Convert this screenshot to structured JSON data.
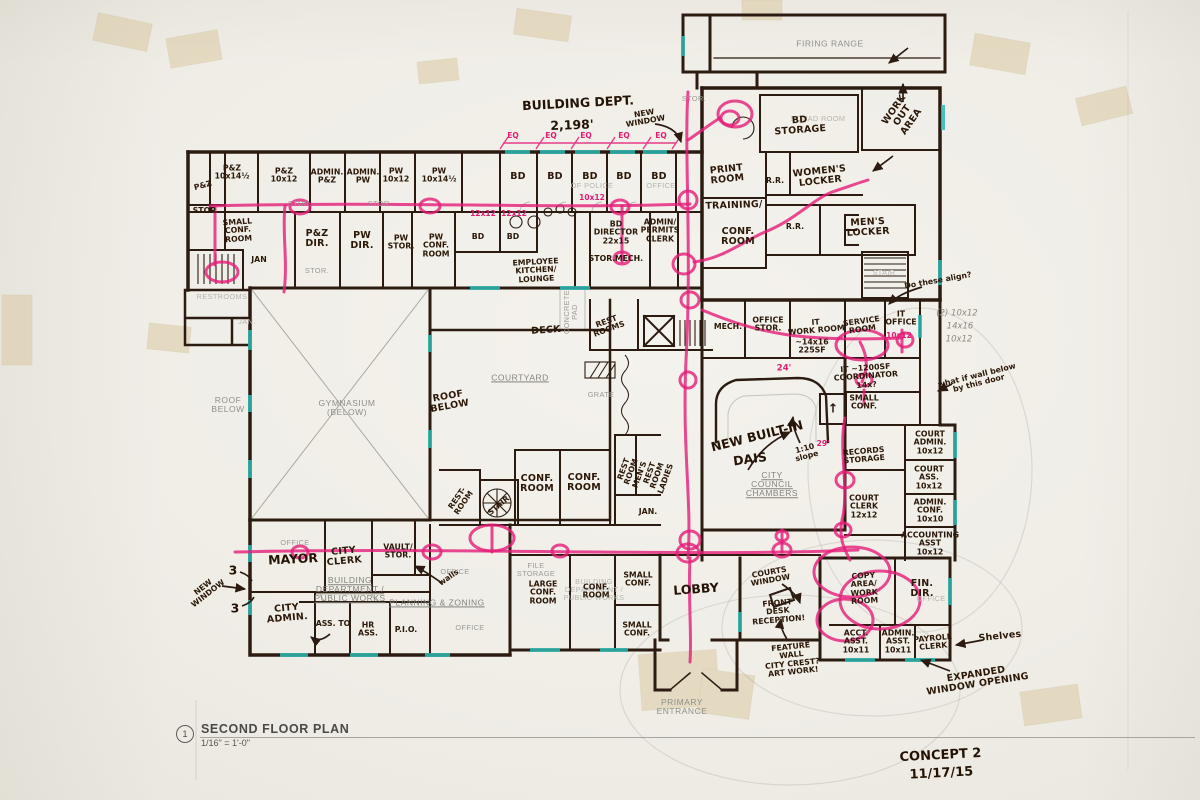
{
  "colors": {
    "ink": "#2b1b10",
    "printed": "#8f8f88",
    "pink": "#e51d78",
    "teal": "#2fb8b2",
    "paper": "#f1efe9",
    "tape": "#d8c79c",
    "pencil": "#8e8a82"
  },
  "title_block": {
    "detail_number": "1",
    "title": "SECOND FLOOR PLAN",
    "scale": "1/16\" = 1'-0\""
  },
  "revision": {
    "concept": "CONCEPT 2",
    "date": "11/17/15"
  },
  "labels": [
    {
      "t": "FIRING RANGE",
      "x": 830,
      "y": 44,
      "c": "pr",
      "n": "room-firing-range"
    },
    {
      "t": "SQUAD ROOM",
      "x": 818,
      "y": 119,
      "c": "prF"
    },
    {
      "t": "BD\nSTORAGE",
      "x": 800,
      "y": 126,
      "c": "hw",
      "r": -4,
      "n": "room-bd-storage"
    },
    {
      "t": "WORK\nOUT\nAREA",
      "x": 903,
      "y": 116,
      "c": "hw",
      "r": -55,
      "n": "room-work-out-area"
    },
    {
      "t": "STOR.",
      "x": 694,
      "y": 99,
      "c": "prS"
    },
    {
      "t": "BUILDING DEPT.",
      "x": 578,
      "y": 103,
      "c": "hwL",
      "r": -3,
      "n": "note-building-dept"
    },
    {
      "t": "2,198'",
      "x": 572,
      "y": 125,
      "c": "hwL",
      "r": -2
    },
    {
      "t": "NEW\nWINDOW",
      "x": 645,
      "y": 118,
      "c": "hwS",
      "r": -10,
      "n": "note-new-window-top"
    },
    {
      "t": "EQ",
      "x": 513,
      "y": 136,
      "c": "pkS"
    },
    {
      "t": "EQ",
      "x": 551,
      "y": 136,
      "c": "pkS"
    },
    {
      "t": "EQ",
      "x": 586,
      "y": 136,
      "c": "pkS"
    },
    {
      "t": "EQ",
      "x": 624,
      "y": 136,
      "c": "pkS"
    },
    {
      "t": "EQ",
      "x": 661,
      "y": 136,
      "c": "pkS"
    },
    {
      "t": "P&Z\n10x14½",
      "x": 232,
      "y": 173,
      "c": "hwS"
    },
    {
      "t": "P&Z\n10x12",
      "x": 284,
      "y": 176,
      "c": "hwS"
    },
    {
      "t": "ADMIN.\nP&Z",
      "x": 327,
      "y": 177,
      "c": "hwS"
    },
    {
      "t": "ADMIN.\nPW",
      "x": 363,
      "y": 177,
      "c": "hwS"
    },
    {
      "t": "PW\n10x12",
      "x": 396,
      "y": 176,
      "c": "hwS"
    },
    {
      "t": "PW\n10x14½",
      "x": 439,
      "y": 176,
      "c": "hwS"
    },
    {
      "t": "BD",
      "x": 518,
      "y": 177,
      "c": "hw"
    },
    {
      "t": "BD",
      "x": 555,
      "y": 177,
      "c": "hw"
    },
    {
      "t": "BD",
      "x": 590,
      "y": 177,
      "c": "hw"
    },
    {
      "t": "BD",
      "x": 624,
      "y": 177,
      "c": "hw"
    },
    {
      "t": "BD",
      "x": 659,
      "y": 177,
      "c": "hw"
    },
    {
      "t": "OF POLICE",
      "x": 592,
      "y": 186,
      "c": "prF"
    },
    {
      "t": "OFFICE",
      "x": 661,
      "y": 186,
      "c": "prF"
    },
    {
      "t": "10x12",
      "x": 592,
      "y": 198,
      "c": "pkS"
    },
    {
      "t": "P&Z",
      "x": 203,
      "y": 186,
      "c": "hwS",
      "r": -15
    },
    {
      "t": "STOR.",
      "x": 206,
      "y": 211,
      "c": "hwS"
    },
    {
      "t": "SMALL\nCONF.\nROOM",
      "x": 238,
      "y": 231,
      "c": "hwS",
      "r": -4
    },
    {
      "t": "STOR.",
      "x": 300,
      "y": 204,
      "c": "prS"
    },
    {
      "t": "STOR.",
      "x": 380,
      "y": 204,
      "c": "prS"
    },
    {
      "t": "P&Z\nDIR.",
      "x": 317,
      "y": 239,
      "c": "hw"
    },
    {
      "t": "PW\nDIR.",
      "x": 362,
      "y": 241,
      "c": "hw"
    },
    {
      "t": "PW\nSTOR.",
      "x": 401,
      "y": 243,
      "c": "hwS"
    },
    {
      "t": "PW\nCONF.\nROOM",
      "x": 436,
      "y": 246,
      "c": "hwS"
    },
    {
      "t": "STOR.",
      "x": 317,
      "y": 271,
      "c": "prS"
    },
    {
      "t": "JAN",
      "x": 259,
      "y": 260,
      "c": "hwS"
    },
    {
      "t": "12x12",
      "x": 483,
      "y": 214,
      "c": "pkS"
    },
    {
      "t": "12x12",
      "x": 514,
      "y": 214,
      "c": "pkS"
    },
    {
      "t": "BD",
      "x": 478,
      "y": 237,
      "c": "hwS"
    },
    {
      "t": "BD",
      "x": 513,
      "y": 237,
      "c": "hwS"
    },
    {
      "t": "EMPLOYEE\nKITCHEN/\nLOUNGE",
      "x": 536,
      "y": 271,
      "c": "hwS",
      "r": -3,
      "n": "room-employee-kitchen"
    },
    {
      "t": "BD\nDIRECTOR\n22x15",
      "x": 616,
      "y": 233,
      "c": "hwS",
      "n": "room-bd-director"
    },
    {
      "t": "STOR.",
      "x": 602,
      "y": 259,
      "c": "hwS"
    },
    {
      "t": "MECH.",
      "x": 629,
      "y": 259,
      "c": "hwS"
    },
    {
      "t": "ADMIN/\nPERMITS\nCLERK",
      "x": 660,
      "y": 231,
      "c": "hwS"
    },
    {
      "t": "PRINT\nROOM",
      "x": 727,
      "y": 175,
      "c": "hw",
      "r": -6
    },
    {
      "t": "R.R.",
      "x": 775,
      "y": 181,
      "c": "hwS"
    },
    {
      "t": "WOMEN'S\nLOCKER",
      "x": 820,
      "y": 177,
      "c": "hw",
      "r": -6,
      "n": "room-womens-locker"
    },
    {
      "t": "TRAINING/",
      "x": 734,
      "y": 206,
      "c": "hw",
      "r": -2
    },
    {
      "t": "CONF.\nROOM",
      "x": 738,
      "y": 237,
      "c": "hw"
    },
    {
      "t": "R.R.",
      "x": 795,
      "y": 227,
      "c": "hwS"
    },
    {
      "t": "MEN'S\nLOCKER",
      "x": 868,
      "y": 228,
      "c": "hw",
      "r": -3,
      "n": "room-mens-locker"
    },
    {
      "t": "STAIR",
      "x": 884,
      "y": 273,
      "c": "prF"
    },
    {
      "t": "Do these align?",
      "x": 938,
      "y": 281,
      "c": "hwS",
      "r": -10,
      "n": "note-do-these-align"
    },
    {
      "t": "(2) 10x12",
      "x": 957,
      "y": 314,
      "c": "pc"
    },
    {
      "t": "14x16",
      "x": 960,
      "y": 327,
      "c": "pc"
    },
    {
      "t": "10x12",
      "x": 959,
      "y": 340,
      "c": "pc"
    },
    {
      "t": "what if wall below\nby this door",
      "x": 978,
      "y": 380,
      "c": "hwS",
      "r": -14,
      "n": "note-wall-below"
    },
    {
      "t": "MECH.",
      "x": 728,
      "y": 327,
      "c": "hwS"
    },
    {
      "t": "OFFICE\nSTOR.",
      "x": 768,
      "y": 325,
      "c": "hwS"
    },
    {
      "t": "IT\nWORK ROOM",
      "x": 816,
      "y": 327,
      "c": "hwS",
      "r": -5
    },
    {
      "t": "~14x16\n225SF",
      "x": 812,
      "y": 347,
      "c": "hwS"
    },
    {
      "t": "SERVICE\nROOM",
      "x": 862,
      "y": 326,
      "c": "hwS",
      "r": -8
    },
    {
      "t": "IT\nOFFICE",
      "x": 901,
      "y": 319,
      "c": "hwS"
    },
    {
      "t": "10x12",
      "x": 899,
      "y": 336,
      "c": "pkS"
    },
    {
      "t": "IT ~1200SF\nCOORDINATOR\n14x?",
      "x": 866,
      "y": 377,
      "c": "hwS",
      "r": -4
    },
    {
      "t": "SMALL\nCONF.",
      "x": 864,
      "y": 403,
      "c": "hwS"
    },
    {
      "t": "24'",
      "x": 784,
      "y": 369,
      "c": "pk"
    },
    {
      "t": "29'",
      "x": 823,
      "y": 444,
      "c": "pkS"
    },
    {
      "t": "1:10\nslope",
      "x": 806,
      "y": 453,
      "c": "hwS",
      "r": -15
    },
    {
      "t": "NEW BUILT-IN",
      "x": 757,
      "y": 436,
      "c": "hwL",
      "r": -14,
      "n": "note-new-built-in-dais"
    },
    {
      "t": "DAIS",
      "x": 750,
      "y": 459,
      "c": "hwL",
      "r": -8
    },
    {
      "t": "CITY\nCOUNCIL\nCHAMBERS",
      "x": 772,
      "y": 485,
      "c": "prU",
      "n": "room-council-chambers"
    },
    {
      "t": "REST\nROOMS",
      "x": 608,
      "y": 326,
      "c": "hwS",
      "r": -20
    },
    {
      "t": "DECK",
      "x": 546,
      "y": 331,
      "c": "hw",
      "r": -4
    },
    {
      "t": "CONCRETE\nPAD",
      "x": 571,
      "y": 312,
      "c": "prS",
      "r": -90
    },
    {
      "t": "COURTYARD",
      "x": 520,
      "y": 378,
      "c": "prU",
      "n": "room-courtyard"
    },
    {
      "t": "GRATE",
      "x": 601,
      "y": 395,
      "c": "prS"
    },
    {
      "t": "ROOF\nBELOW",
      "x": 228,
      "y": 405,
      "c": "pr"
    },
    {
      "t": "GYMNASIUM\n(BELOW)",
      "x": 347,
      "y": 408,
      "c": "pr",
      "n": "room-gymnasium"
    },
    {
      "t": "ROOF\nBELOW",
      "x": 449,
      "y": 402,
      "c": "hw",
      "r": -10
    },
    {
      "t": "RESTROOMS",
      "x": 222,
      "y": 297,
      "c": "prF"
    },
    {
      "t": "JAN.",
      "x": 247,
      "y": 322,
      "c": "prF"
    },
    {
      "t": "RECORDS\nSTORAGE",
      "x": 864,
      "y": 456,
      "c": "hwS",
      "r": -5
    },
    {
      "t": "COURT\nCLERK\n12x12",
      "x": 864,
      "y": 507,
      "c": "hwS"
    },
    {
      "t": "COURT\nADMIN.\n10x12",
      "x": 930,
      "y": 443,
      "c": "hwS"
    },
    {
      "t": "COURT\nASS.\n10x12",
      "x": 929,
      "y": 478,
      "c": "hwS"
    },
    {
      "t": "ADMIN.\nCONF.\n10x10",
      "x": 930,
      "y": 511,
      "c": "hwS"
    },
    {
      "t": "ACCOUNTING\nASST\n10x12",
      "x": 930,
      "y": 544,
      "c": "hwS"
    },
    {
      "t": "COPY\nAREA/\nWORK\nROOM",
      "x": 864,
      "y": 589,
      "c": "hwS",
      "r": -3
    },
    {
      "t": "FIN.\nDIR.",
      "x": 922,
      "y": 589,
      "c": "hw"
    },
    {
      "t": "OFFICE",
      "x": 931,
      "y": 599,
      "c": "prF"
    },
    {
      "t": "ACCT.\nASST.\n10x11",
      "x": 856,
      "y": 642,
      "c": "hwS"
    },
    {
      "t": "ADMIN.\nASST.\n10x11",
      "x": 898,
      "y": 642,
      "c": "hwS"
    },
    {
      "t": "PAYROLL\nCLERK",
      "x": 933,
      "y": 643,
      "c": "hwS",
      "r": -5
    },
    {
      "t": "Shelves",
      "x": 1000,
      "y": 637,
      "c": "hw",
      "r": -6,
      "n": "note-shelves"
    },
    {
      "t": "EXPANDED\nWINDOW OPENING",
      "x": 977,
      "y": 680,
      "c": "hw",
      "r": -9,
      "n": "note-expanded-window"
    },
    {
      "t": "LOBBY",
      "x": 696,
      "y": 589,
      "c": "hwL",
      "r": -4,
      "n": "room-lobby"
    },
    {
      "t": "COURTS\nWINDOW",
      "x": 770,
      "y": 577,
      "c": "hwS",
      "r": -10
    },
    {
      "t": "FRONT\nDESK\nRECEPTION!",
      "x": 778,
      "y": 612,
      "c": "hwS",
      "r": -5,
      "n": "note-front-desk"
    },
    {
      "t": "FEATURE\nWALL\nCITY CREST?\nART WORK!",
      "x": 792,
      "y": 660,
      "c": "hwS",
      "r": -6,
      "n": "note-feature-wall"
    },
    {
      "t": "PRIMARY\nENTRANCE",
      "x": 682,
      "y": 707,
      "c": "pr",
      "n": "label-primary-entrance"
    },
    {
      "t": "SMALL\nCONF.",
      "x": 638,
      "y": 580,
      "c": "hwS"
    },
    {
      "t": "SMALL\nCONF.",
      "x": 637,
      "y": 630,
      "c": "hwS"
    },
    {
      "t": "FILE\nSTORAGE",
      "x": 536,
      "y": 570,
      "c": "prS"
    },
    {
      "t": "LARGE\nCONF.\nROOM",
      "x": 543,
      "y": 593,
      "c": "hwS"
    },
    {
      "t": "BUILDING\nDEPARTMENT /\nPUBLIC WORKS",
      "x": 594,
      "y": 590,
      "c": "prF"
    },
    {
      "t": "CONF.\nROOM",
      "x": 596,
      "y": 592,
      "c": "hwS"
    },
    {
      "t": "BUILDING\nDEPARTMENT /\nPUBLIC WORKS",
      "x": 350,
      "y": 590,
      "c": "prU",
      "n": "dept-building-public-works"
    },
    {
      "t": "PLANNING & ZONING",
      "x": 437,
      "y": 603,
      "c": "prU",
      "n": "dept-planning-zoning"
    },
    {
      "t": "OFFICE",
      "x": 295,
      "y": 543,
      "c": "prS"
    },
    {
      "t": "OFFICE",
      "x": 455,
      "y": 572,
      "c": "prS"
    },
    {
      "t": "OFFICE",
      "x": 470,
      "y": 628,
      "c": "prS"
    },
    {
      "t": "MAYOR",
      "x": 293,
      "y": 559,
      "c": "hwL",
      "r": -3,
      "n": "room-mayor"
    },
    {
      "t": "CITY\nCLERK",
      "x": 344,
      "y": 557,
      "c": "hw",
      "r": -5,
      "n": "room-city-clerk"
    },
    {
      "t": "VAULT/\nSTOR.",
      "x": 398,
      "y": 552,
      "c": "hwS"
    },
    {
      "t": "walls",
      "x": 449,
      "y": 578,
      "c": "hwS",
      "r": -35
    },
    {
      "t": "CITY\nADMIN.",
      "x": 287,
      "y": 614,
      "c": "hw",
      "r": -5,
      "n": "room-city-admin"
    },
    {
      "t": "ASS. TO",
      "x": 333,
      "y": 624,
      "c": "hwS"
    },
    {
      "t": "HR\nASS.",
      "x": 368,
      "y": 630,
      "c": "hwS"
    },
    {
      "t": "P.I.O.",
      "x": 406,
      "y": 630,
      "c": "hwS"
    },
    {
      "t": "NEW\nWINDOW",
      "x": 206,
      "y": 591,
      "c": "hwS",
      "r": -38,
      "n": "note-new-window-left"
    },
    {
      "t": "3",
      "x": 233,
      "y": 570,
      "c": "hwL"
    },
    {
      "t": "3",
      "x": 235,
      "y": 608,
      "c": "hwL"
    },
    {
      "t": "CONF.\nROOM",
      "x": 537,
      "y": 484,
      "c": "hw"
    },
    {
      "t": "CONF.\nROOM",
      "x": 584,
      "y": 483,
      "c": "hw"
    },
    {
      "t": "REST-\nROOM",
      "x": 461,
      "y": 501,
      "c": "hwS",
      "r": -55
    },
    {
      "t": "STAIR",
      "x": 499,
      "y": 506,
      "c": "hwS",
      "r": -40
    },
    {
      "t": "REST\nROOM\nMEN'S",
      "x": 632,
      "y": 472,
      "c": "hwS",
      "r": -70
    },
    {
      "t": "REST\nROOM\nLADIES",
      "x": 658,
      "y": 476,
      "c": "hwS",
      "r": -70
    },
    {
      "t": "JAN.",
      "x": 648,
      "y": 512,
      "c": "hwS"
    },
    {
      "t": "↑",
      "x": 833,
      "y": 408,
      "c": "hwL"
    }
  ]
}
